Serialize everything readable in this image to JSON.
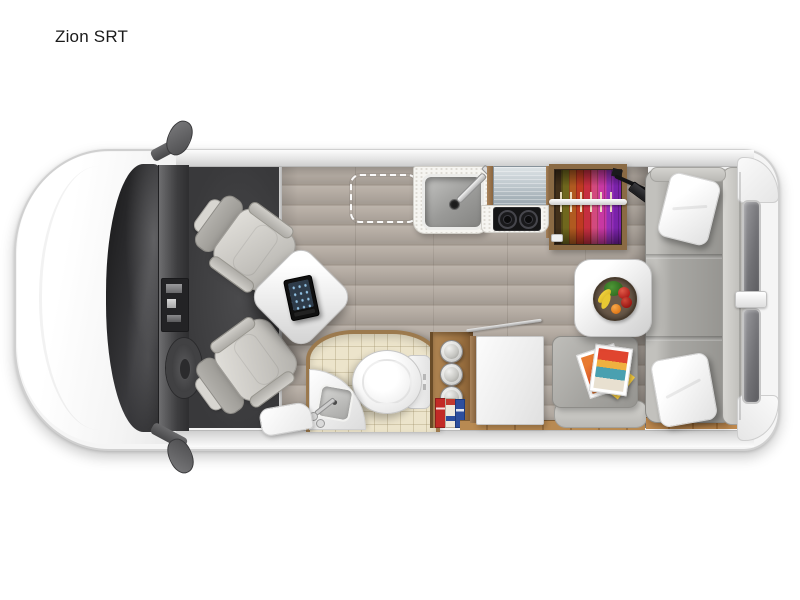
{
  "page": {
    "title": "Zion SRT",
    "background": "#ffffff"
  },
  "floorplan": {
    "vehicle_type": "class-b-camper-van-top-view-floorplan",
    "front": "left",
    "rear": "right",
    "areas": {
      "cab": [
        "hood",
        "windshield",
        "dashboard",
        "center-console",
        "steering-wheel",
        "driver-swivel-seat",
        "passenger-swivel-seat",
        "left-mirror",
        "right-mirror"
      ],
      "lounge": [
        "pedestal-table",
        "tablet",
        "optional-feature-dashed-outline"
      ],
      "kitchen": [
        "counter-with-sink",
        "faucet",
        "refrigerator",
        "two-burner-cooktop",
        "wardrobe-with-hanging-clothes",
        "tv-on-swivel-arm"
      ],
      "bathroom": [
        "arched-tile-room",
        "toilet",
        "corner-sink",
        "pantry-shelf-with-cans-and-boxes"
      ],
      "rear_lounge": [
        "storage-cabinet",
        "bench-seat-with-magazines",
        "side-table-with-fruit-bowl",
        "sofa-bed",
        "throw-pillows",
        "rear-doors-with-windows"
      ]
    }
  },
  "colors": {
    "bg": "#ffffff",
    "title-color": "#1a1a1a",
    "body-white": "#f5f5f5",
    "body-outline": "#d0d0d0",
    "glass-dark": "#3a3a3d",
    "cab-carpet": "#39393b",
    "wood-floor": "#b5aca3",
    "bath-tile": "#ece4cb",
    "wood-trim": "#9c7a4e",
    "counter-white": "#f6f5f1",
    "sofa-gray": "#a9a8a4",
    "sofa-light": "#d8d7d3"
  }
}
